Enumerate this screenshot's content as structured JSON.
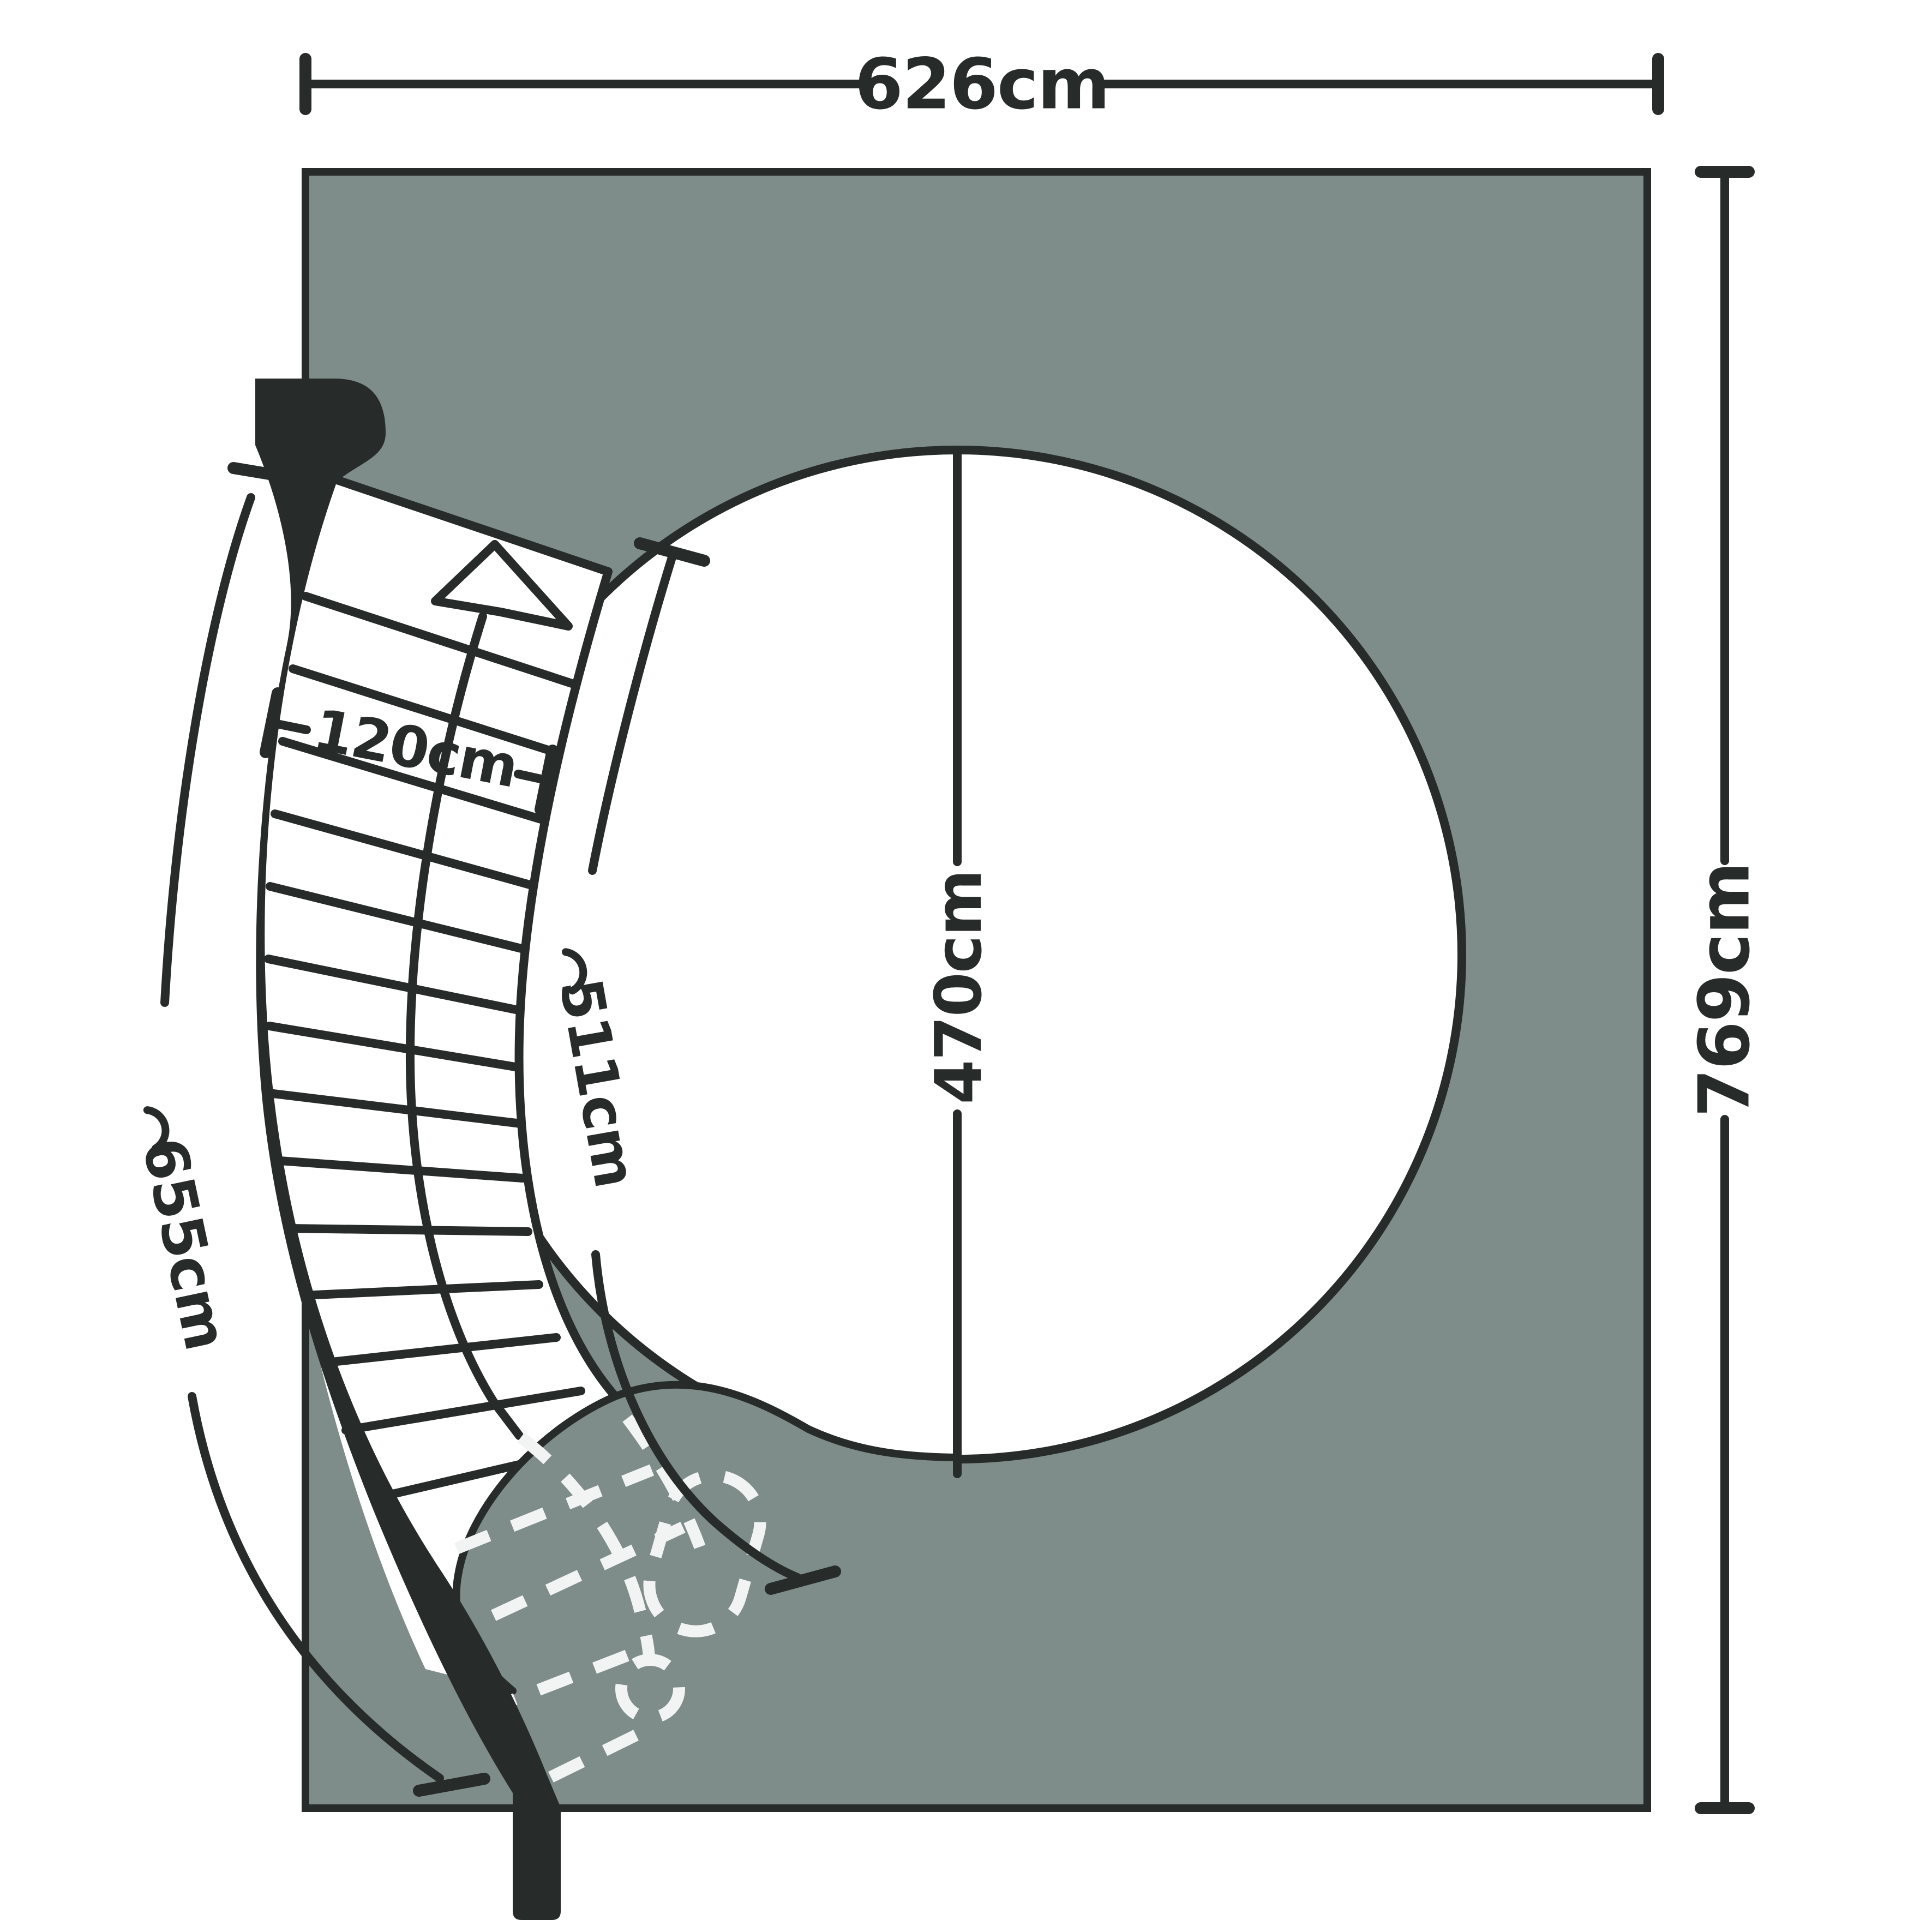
{
  "diagram": {
    "type": "floor-plan-curved-staircase-with-circular-opening",
    "dimensions": {
      "plan_width": {
        "label": "626cm",
        "orientation": "horizontal-top"
      },
      "plan_height": {
        "label": "769cm",
        "orientation": "vertical-right"
      },
      "opening_diameter": {
        "label": "470cm",
        "orientation": "vertical-through-opening"
      },
      "inner_stringer_arc": {
        "label": "511cm",
        "prefix_symbol": "arc-symbol"
      },
      "outer_stringer_arc": {
        "label": "655cm",
        "prefix_symbol": "arc-symbol"
      },
      "stair_width": {
        "label": "120cm",
        "orientation": "across-treads"
      }
    },
    "stairs": {
      "visible_step_lines": 14,
      "hidden_step_lines": 4,
      "walkline_direction_arrow": "up",
      "hidden_parts_style": "white-dashed"
    },
    "icons": [
      "up-arrow-icon",
      "arc-symbol-icon"
    ],
    "colors": {
      "ink": "#272b2a",
      "floor_fill": "#7e8d89",
      "paper": "#ffffff",
      "hidden_lines": "#f2f4f3"
    }
  }
}
